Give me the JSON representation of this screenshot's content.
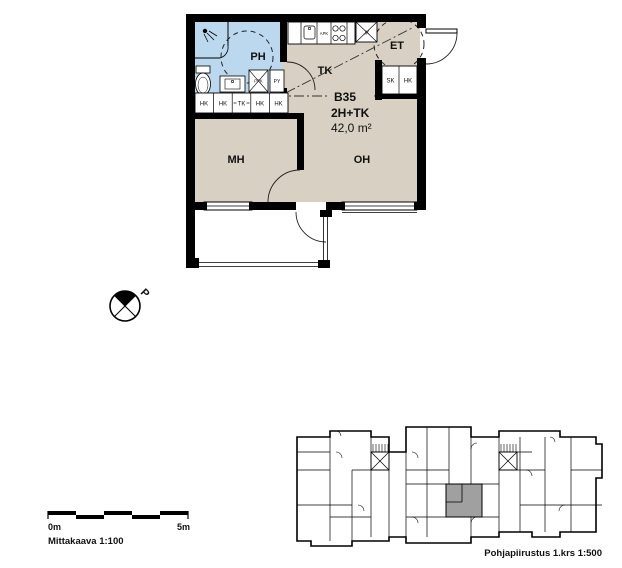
{
  "floor_plan": {
    "unit": {
      "id": "B35",
      "type": "2H+TK",
      "area": "42,0 m²"
    },
    "rooms": {
      "bathroom": "PH",
      "kitchen": "TK",
      "entry": "ET",
      "bedroom": "MH",
      "living_room": "OH"
    },
    "wardrobe_row": [
      "HK",
      "HK",
      "TK",
      "HK",
      "HK"
    ],
    "entry_closets": [
      "SK",
      "HK"
    ],
    "bathroom_appliances": {
      "washer_reservation": "PPK",
      "laundry_cabinet": "PY"
    },
    "kitchen_appliances": {
      "dishwasher_reservation": "APK",
      "fridge_reservation": "JK"
    }
  },
  "compass": {
    "north_label": "P"
  },
  "scale_bar": {
    "label_start": "0m",
    "label_end": "5m",
    "caption": "Mittakaava 1:100"
  },
  "key_plan": {
    "caption": "Pohjapiirustus 1.krs 1:500"
  },
  "colors": {
    "room_fill": "#d8d0c2",
    "wet_room_fill": "#bcd8ee",
    "wall": "#000000",
    "highlight_unit": "#a0a0a0",
    "line": "#222222"
  }
}
